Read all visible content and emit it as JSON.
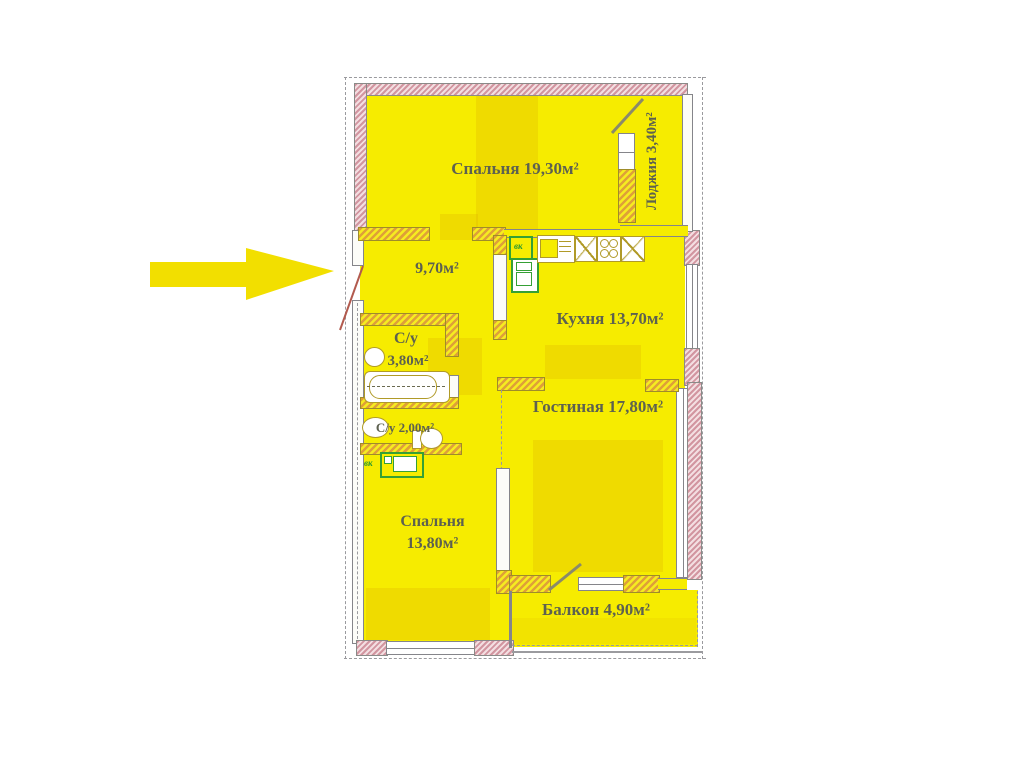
{
  "plan": {
    "type": "apartment-floor-plan",
    "rooms": {
      "bedroom1": {
        "label": "Спальня 19,30м²"
      },
      "loggia": {
        "label": "Лоджия 3,40м²"
      },
      "hallway": {
        "label": "9,70м²"
      },
      "kitchen": {
        "label": "Кухня 13,70м²"
      },
      "bathroom": {
        "name": "С/у",
        "area": "3,80м²"
      },
      "wc": {
        "label": "С/у 2,00м²"
      },
      "living": {
        "label": "Гостиная 17,80м²"
      },
      "bedroom2": {
        "name": "Спальня",
        "area": "13,80м²"
      },
      "balcony": {
        "label": "Балкон 4,90м²"
      }
    },
    "marks": {
      "vent": "вк"
    },
    "colors": {
      "room_fill": "#f6ec00",
      "exterior_wall": "#d295a0",
      "interior_wall": "#dfa038",
      "outline": "#85858a",
      "label_text": "#5d6150",
      "fixture_green": "#35a035",
      "entrance_arrow": "#f2df00",
      "door_swing": "#b25a4e"
    }
  }
}
